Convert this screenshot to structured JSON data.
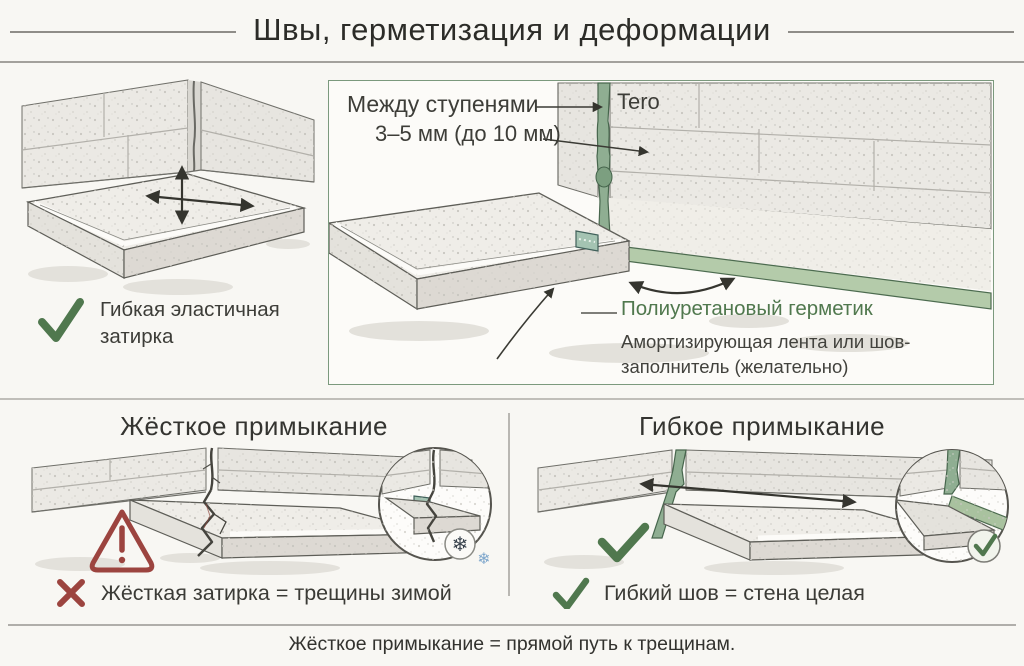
{
  "header": {
    "title": "Швы, герметизация и деформации"
  },
  "flexible_grout_panel": {
    "caption": "Гибкая эластичная затирка"
  },
  "sealant_panel": {
    "between_steps": "Между ступенями",
    "tero": "Tero",
    "gap": "3–5 мм (до 10 мм)",
    "sealant": "Полиуретановый герметик",
    "tape_line1": "Амортизирующая лента или шов-",
    "tape_line2": "заполнитель (желательно)"
  },
  "rigid_panel": {
    "heading": "Жёсткое примыкание",
    "verdict": "Жёсткая затирка = трещины зимой"
  },
  "flexible_panel": {
    "heading": "Гибкое примыкание",
    "verdict": "Гибкий шов = стена целая"
  },
  "footer": {
    "note": "Жёсткое примыкание = прямой путь к трещинам."
  },
  "icons": {
    "snowflake": "❄"
  },
  "colors": {
    "accent_green": "#50784e",
    "sealant_green": "#8fae92",
    "warn_red": "#9c443f",
    "box_border": "#7b997d",
    "text_dark": "#3a3a35"
  }
}
